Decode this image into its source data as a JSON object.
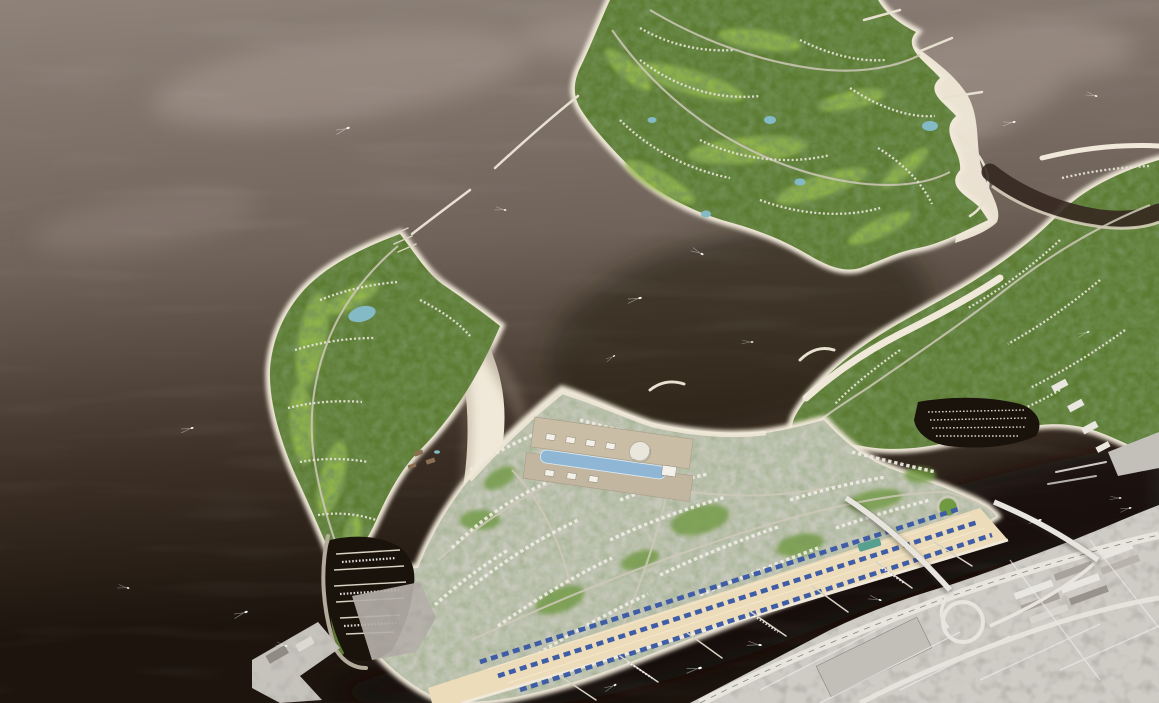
{
  "meta": {
    "title": "Aerial 3D masterplan rendering of a coastal island development beside an existing city",
    "width": "1159",
    "height": "703"
  },
  "scene": {
    "description": "Bird's-eye architectural rendering: new green islands with golf courses, white beaches, marinas and a dense urban district shown in full colour on dark sea; the existing city, port warehouses and a highway interchange with two creek bridges appear desaturated at lower right.",
    "regions": {
      "sea": "Open sea with pale sandbars",
      "golf_island": "Golf-course island with villa rows, fairways, ponds, jetties and beaches",
      "golf_peninsula": "Triangular golf peninsula with crescent swimming beach and small marina",
      "east_arm": "Curving garden-residential arm with lagoon, beaches and boat basin",
      "urban_district": "Dense mid-rise urban district with shopping mall, glass atrium and dome",
      "souk": "Beachfront souk strip with blue-roofed stalls, promenade and piers",
      "west_marina": "Western marina basin with berthed yachts",
      "creek": "Dark creek channel crossed by two road bridges",
      "existing_city": "Existing city, port warehouses and highway interchange (desaturated)",
      "wharf": "Grey harbour wharf structure",
      "boats": "Small boats trailing white wakes"
    }
  },
  "colors": {
    "water_top": "#8e8279",
    "water_mid": "#70635a",
    "water_deep": "#3e3127",
    "water_dark": "#1c140d",
    "sandbar": "#a79a91",
    "lagoon_shadow": "#241a11",
    "creek": "#120c07",
    "beach": "#f0e8d8",
    "beach_shadow": "#8d7e70",
    "green_base": "#5d7c33",
    "green_dark": "#2f4a1d",
    "fairway": "#96ba4d",
    "pond": "#83bac6",
    "villa": "#e6e3d6",
    "road": "#cfc9ba",
    "urban_base": "#c6c8ba",
    "building": "#edebe2",
    "mall_tan": "#c9bda6",
    "mall_roof": "#8fb6d4",
    "park": "#6f9a40",
    "sand_strip": "#ecdcba",
    "souk_blue": "#3f5da6",
    "teal_roof": "#57a090",
    "marina_water": "#1a130c",
    "dock": "#d8d2c3",
    "gray_city": "#cfccc6",
    "gray_dark": "#8f8b84",
    "highway": "#e8e5de",
    "boat": "#ffffff"
  }
}
